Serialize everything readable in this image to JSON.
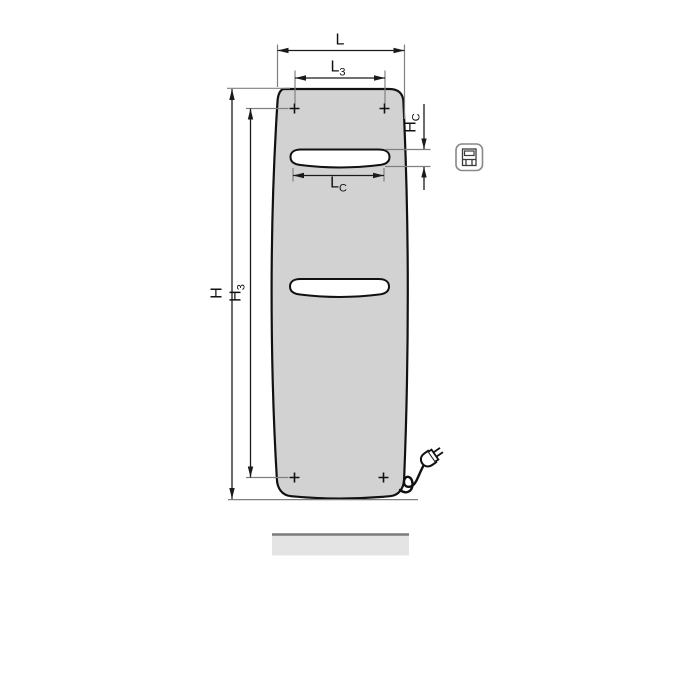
{
  "diagram": {
    "type": "technical-dimension-drawing",
    "subject": "panel radiator, front view, with power cord and plug",
    "labels": {
      "L": {
        "base": "L",
        "sub": ""
      },
      "L3": {
        "base": "L",
        "sub": "3"
      },
      "H": {
        "base": "H",
        "sub": ""
      },
      "H3": {
        "base": "H",
        "sub": "3"
      },
      "HC": {
        "base": "H",
        "sub": "C"
      },
      "LC": {
        "base": "L",
        "sub": "C"
      }
    },
    "icons": [
      "radiator-front-pictogram-icon",
      "power-plug-icon",
      "mounting-cross-marker"
    ],
    "colors": {
      "background": "#ffffff",
      "panel_fill": "#d2d2d2",
      "outline": "#111111",
      "dimension_line": "#1a1a1a",
      "extension_line": "#808080",
      "slot_fill": "#ffffff",
      "floor_bar_fill": "#e4e4e4",
      "floor_bar_edge": "#7d7d7d"
    }
  }
}
